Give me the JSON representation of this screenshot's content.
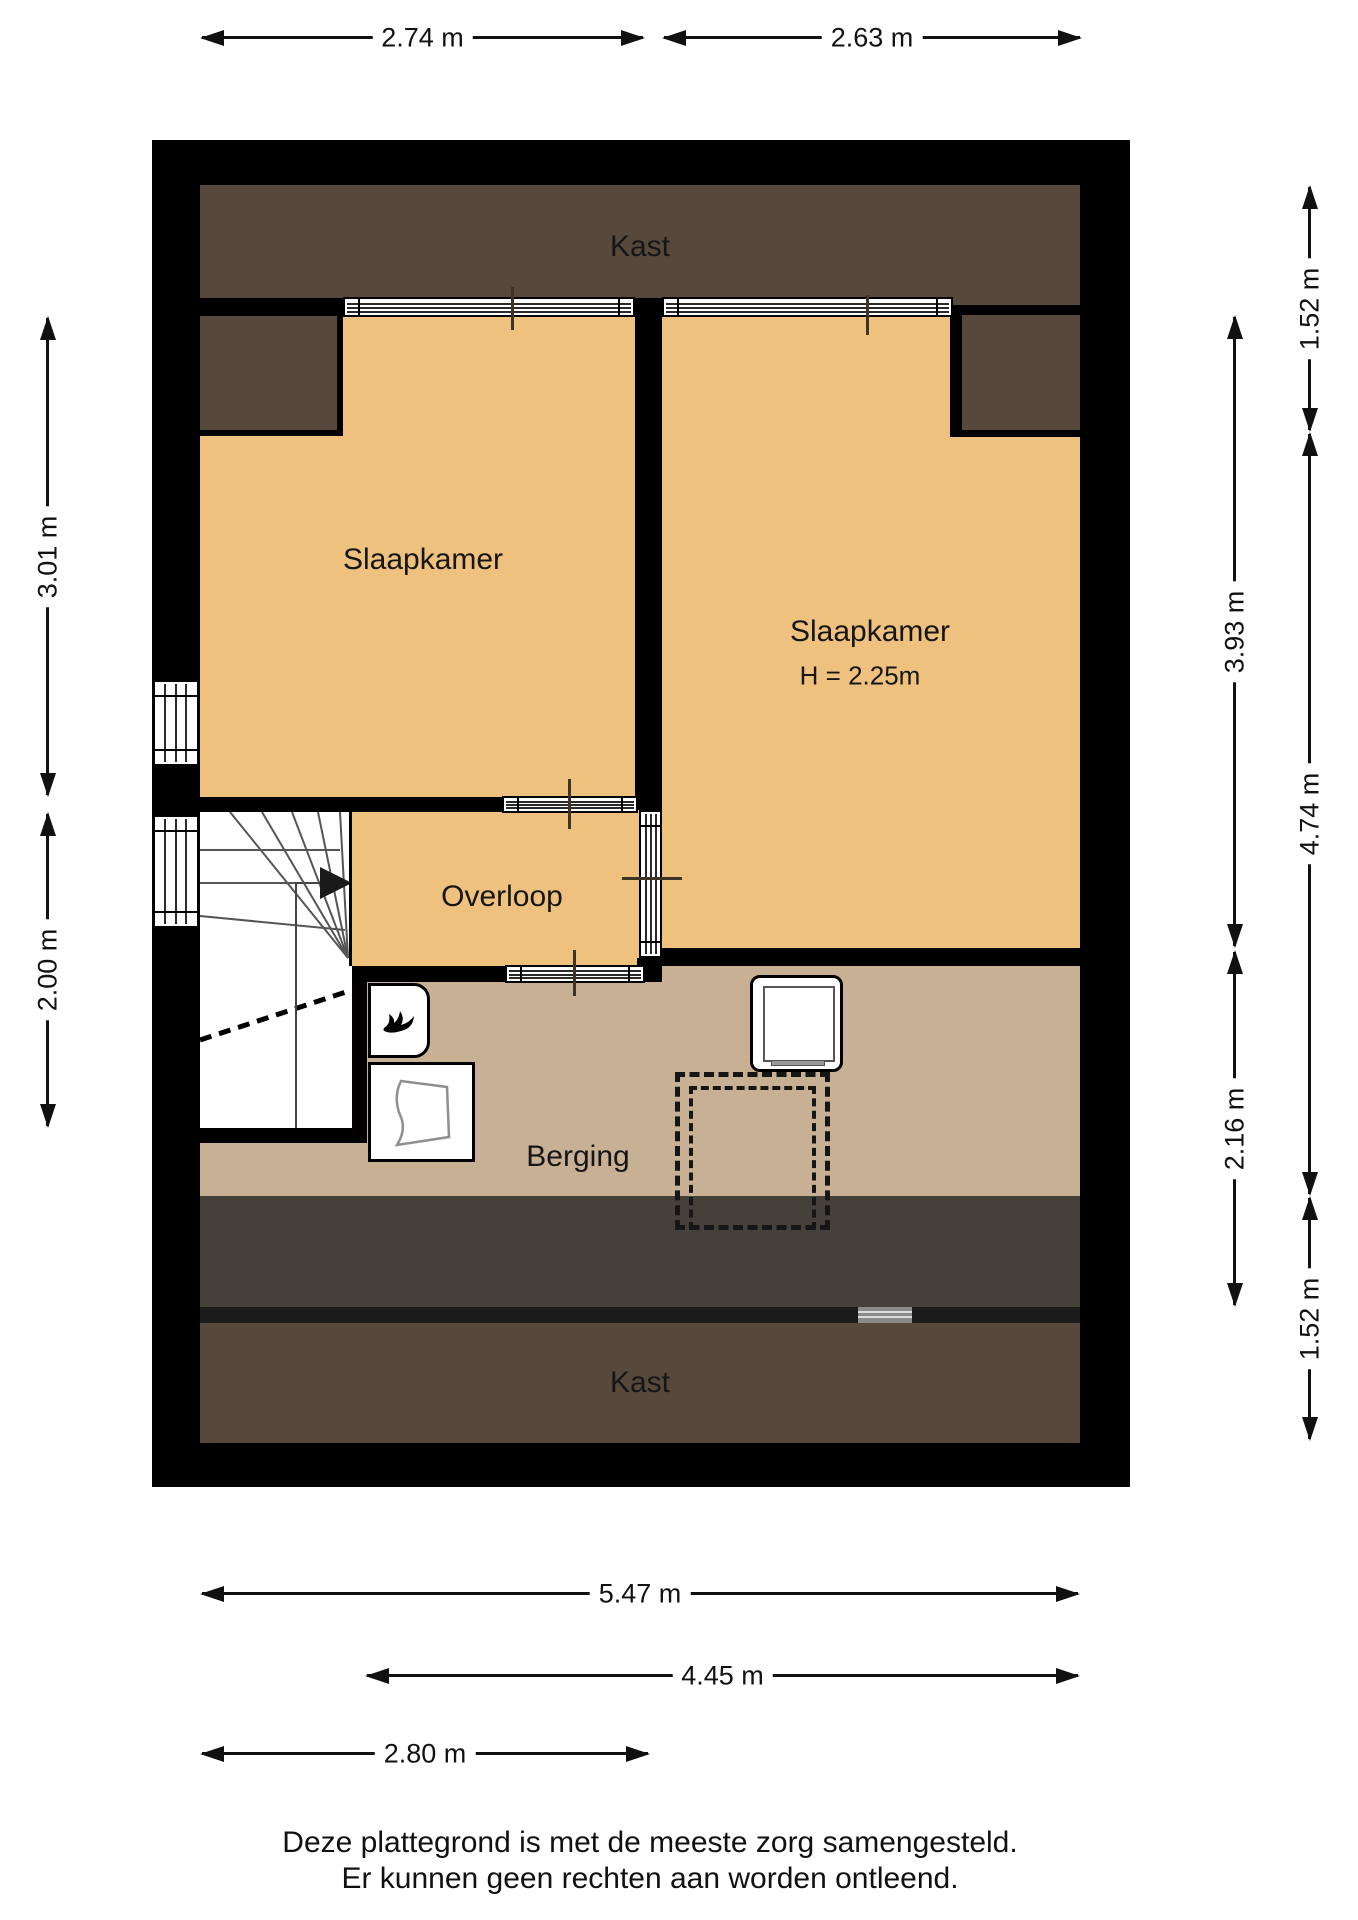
{
  "colors": {
    "wall": "#000000",
    "wall_thin": "#1b1b1b",
    "room_orange": "#eec17e",
    "room_beige": "#c8b094",
    "closet_brown": "#56493c",
    "attic_strip": "#45413a",
    "white": "#ffffff"
  },
  "rooms": {
    "kast_top": "Kast",
    "slaapkamer_left": "Slaapkamer",
    "slaapkamer_right": "Slaapkamer",
    "slaapkamer_right_height": "H = 2.25m",
    "overloop": "Overloop",
    "berging": "Berging",
    "kast_bottom": "Kast"
  },
  "dimensions": {
    "top": [
      {
        "label": "2.74 m"
      },
      {
        "label": "2.63 m"
      }
    ],
    "left": [
      {
        "label": "3.01 m"
      },
      {
        "label": "2.00 m"
      }
    ],
    "right_inner": [
      {
        "label": "3.93 m"
      },
      {
        "label": "2.16 m"
      }
    ],
    "right_outer": [
      {
        "label": "1.52 m"
      },
      {
        "label": "4.74 m"
      },
      {
        "label": "1.52 m"
      }
    ],
    "bottom": [
      {
        "label": "5.47 m"
      },
      {
        "label": "4.45 m"
      },
      {
        "label": "2.80 m"
      }
    ]
  },
  "footer": {
    "line1": "Deze plattegrond is met de meeste zorg samengesteld.",
    "line2": "Er kunnen geen rechten aan worden ontleend."
  }
}
